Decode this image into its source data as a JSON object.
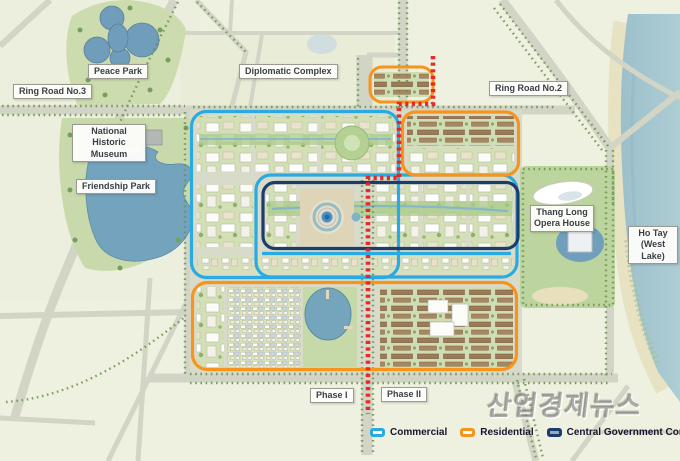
{
  "labels": {
    "peace_park": "Peace Park",
    "ring_road_3": "Ring Road No.3",
    "diplomatic_complex": "Diplomatic Complex",
    "ring_road_2": "Ring Road No.2",
    "national_historic_museum": "National Historic Museum",
    "friendship_park": "Friendship Park",
    "thang_long_opera_house": "Thang Long Opera House",
    "ho_tay": "Ho Tay (West Lake)",
    "phase_1": "Phase I",
    "phase_2": "Phase II"
  },
  "legend": {
    "items": [
      {
        "label": "Commercial",
        "color": "#29abe2"
      },
      {
        "label": "Residential",
        "color": "#f7941d"
      },
      {
        "label": "Central Government Complex",
        "color": "#1c3c6b"
      }
    ]
  },
  "phase_boundary_color": "#e62222",
  "watermark": "산업경제뉴스"
}
